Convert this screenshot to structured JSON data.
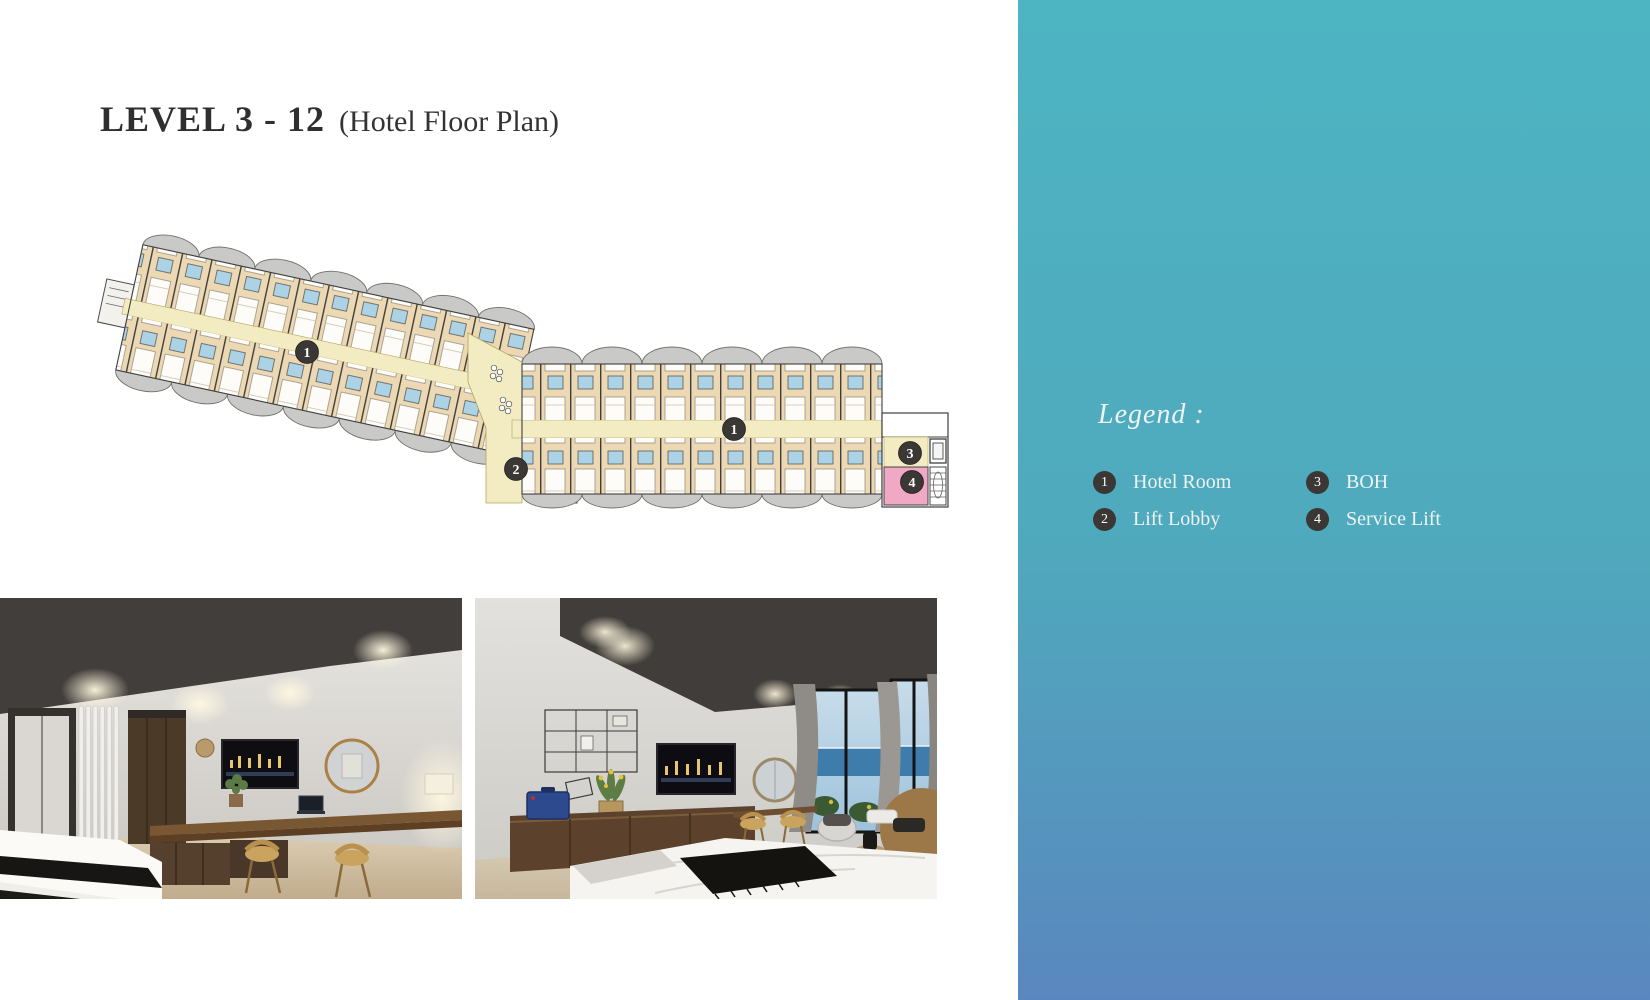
{
  "title": {
    "main": "LEVEL 3 - 12",
    "sub": "(Hotel Floor Plan)"
  },
  "legend": {
    "heading": "Legend :",
    "items": [
      {
        "num": "1",
        "label": "Hotel Room"
      },
      {
        "num": "2",
        "label": "Lift Lobby"
      },
      {
        "num": "3",
        "label": "BOH"
      },
      {
        "num": "4",
        "label": "Service Lift"
      }
    ]
  },
  "plan": {
    "markers": [
      {
        "label": "1"
      },
      {
        "label": "1"
      },
      {
        "label": "2"
      },
      {
        "label": "3"
      },
      {
        "label": "4"
      }
    ]
  },
  "colors": {
    "panel_top": "#4db4c2",
    "panel_mid": "#4fa9bd",
    "panel_bottom": "#5a87bf",
    "badge": "#3a3734",
    "room_tan": "#ecd9b4",
    "corridor_yellow": "#f3ecc3",
    "bath_blue": "#abd2e5",
    "balcony_gray": "#c9c9c7",
    "service_lift_pink": "#f0a9c4",
    "title_text": "#2f2f31",
    "legend_text": "#eef3f3"
  }
}
